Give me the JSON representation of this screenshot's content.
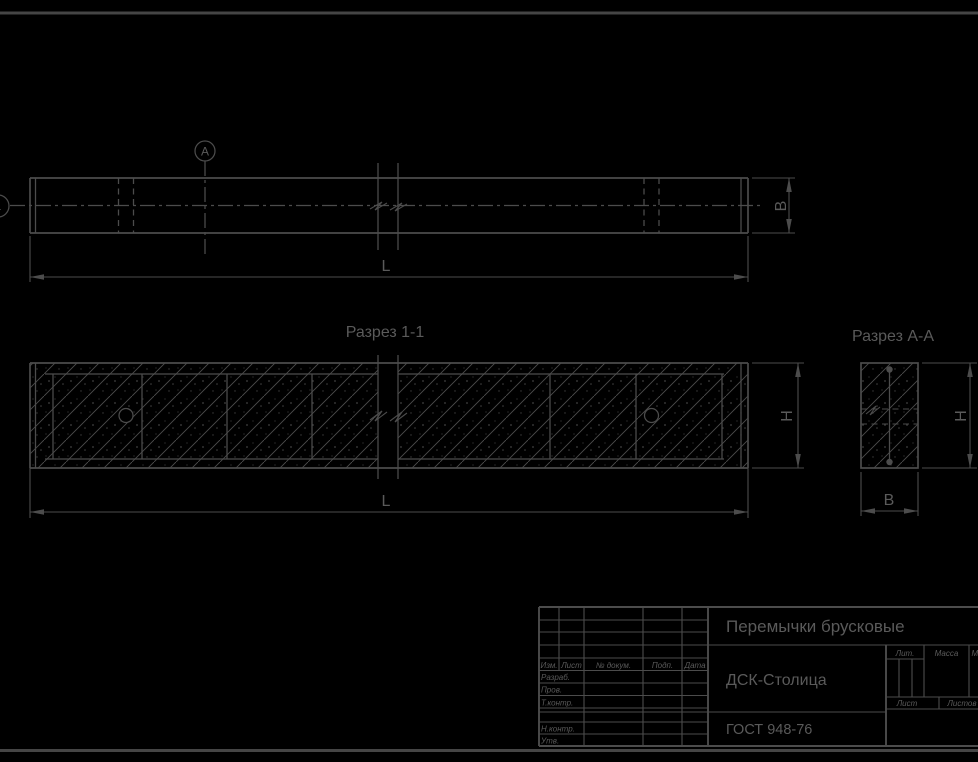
{
  "colors": {
    "background": "#000000",
    "line": "#4c4c4c",
    "frame": "#454545",
    "text": "#5a5a5a"
  },
  "plan": {
    "section_letter": "А",
    "left_cut_mark": "1",
    "dim_length": "L",
    "dim_width": "B"
  },
  "section11": {
    "title": "Разрез 1-1",
    "dim_length": "L",
    "dim_height": "H"
  },
  "sectionAA": {
    "title": "Разрез А-А",
    "dim_width": "B",
    "dim_height": "H"
  },
  "titleblock": {
    "product": "Перемычки брусковые",
    "company": "ДСК-Столица",
    "standard": "ГОСТ 948-76",
    "header": {
      "izm": "Изм.",
      "list": "Лист",
      "doc": "№ докум.",
      "podp": "Подп.",
      "data": "Дата"
    },
    "roles": {
      "razrab": "Разраб.",
      "prov": "Пров.",
      "tkontr": "Т.контр.",
      "nkontr": "Н.контр.",
      "utv": "Утв."
    },
    "stamp": {
      "lit": "Лит.",
      "massa": "Масса",
      "scale": "Масштаб",
      "list": "Лист",
      "listov": "Листов"
    }
  }
}
